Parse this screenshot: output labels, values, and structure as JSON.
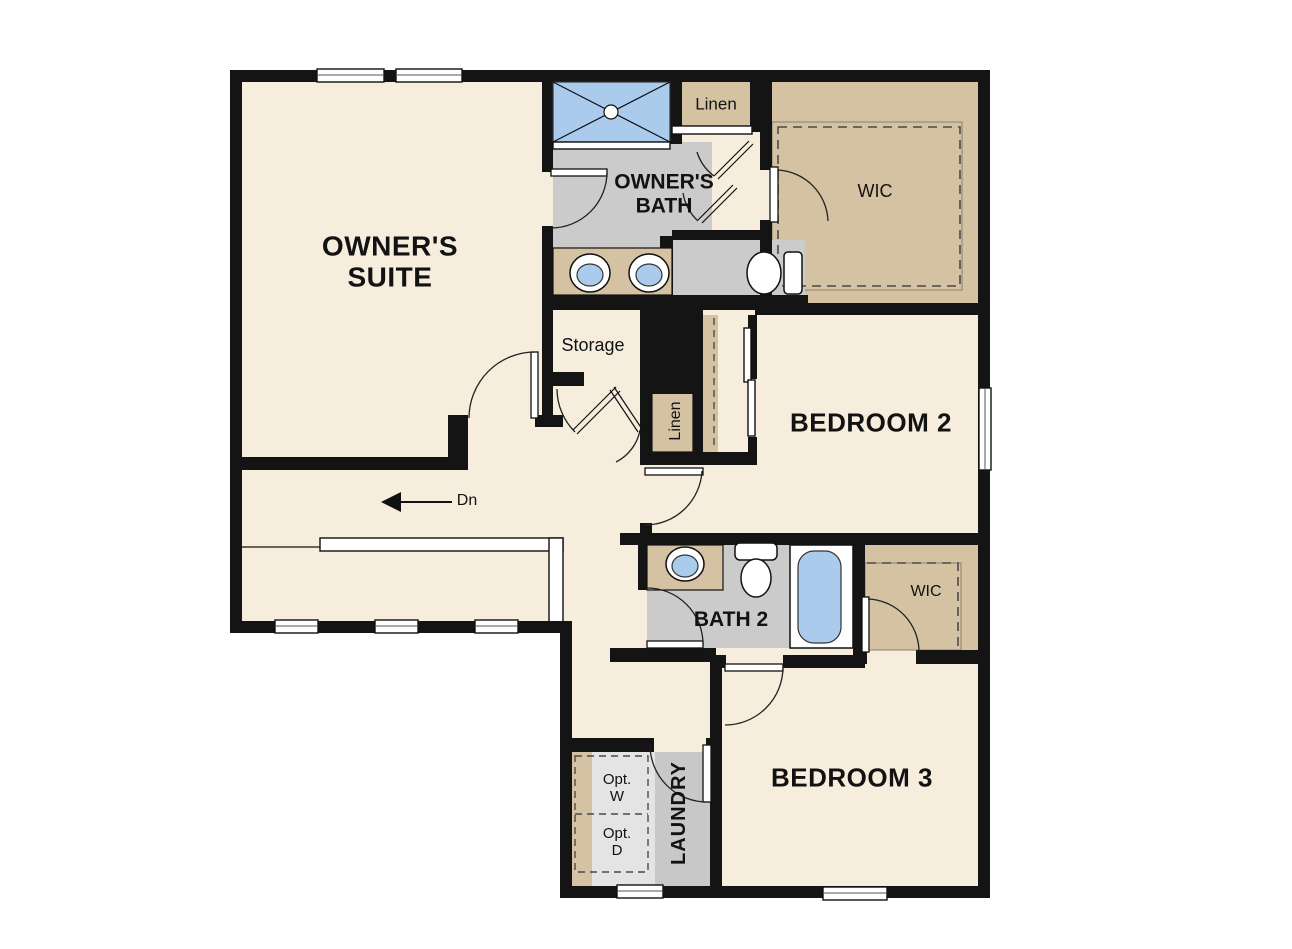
{
  "plan_type": "residential-floor-plan",
  "colors": {
    "background": "#ffffff",
    "floor": "#f6eddd",
    "wall": "#141414",
    "bath_floor": "#cbcbcb",
    "laundry_floor": "#c8c8c8",
    "appliance_area": "#e4e4e4",
    "casework_tan": "#d5c2a3",
    "fixture_blue": "#abcbed"
  },
  "rooms": {
    "owners_suite": {
      "line1": "OWNER'S",
      "line2": "SUITE"
    },
    "owners_bath": {
      "line1": "OWNER'S",
      "line2": "BATH"
    },
    "linen_upper": {
      "label": "Linen"
    },
    "wic_owners": {
      "label": "WIC"
    },
    "storage": {
      "label": "Storage"
    },
    "linen_hall": {
      "label": "Linen"
    },
    "bedroom_2": {
      "label": "BEDROOM 2"
    },
    "bath_2": {
      "label": "BATH 2"
    },
    "wic_secondary": {
      "label": "WIC"
    },
    "laundry": {
      "label": "LAUNDRY",
      "washer": {
        "line1": "Opt.",
        "line2": "W"
      },
      "dryer": {
        "line1": "Opt.",
        "line2": "D"
      }
    },
    "bedroom_3": {
      "label": "BEDROOM 3"
    }
  },
  "stairs": {
    "label": "Dn"
  },
  "fixtures": [
    "shower",
    "double-vanity-sinks",
    "water-closet-toilet",
    "walk-in-closet-shelving",
    "storage-closet",
    "linen-closet",
    "bypass-closet-doors",
    "single-vanity-sink",
    "toilet",
    "bathtub",
    "optional-washer",
    "optional-dryer",
    "stairs-down",
    "windows",
    "swing-doors"
  ]
}
